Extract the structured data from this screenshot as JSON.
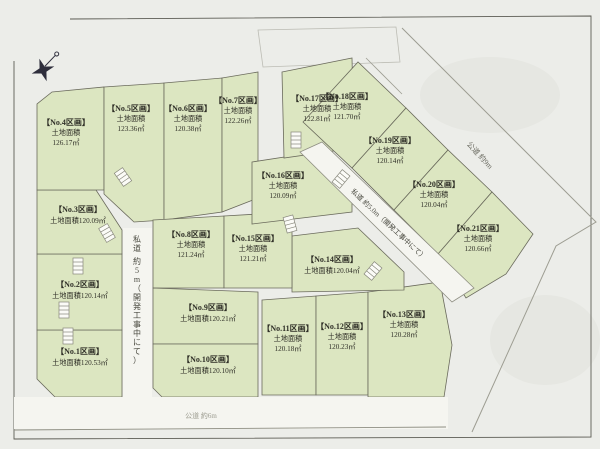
{
  "map": {
    "type": "land-subdivision-plot-map",
    "colors": {
      "paper": "#ecede9",
      "blob": "#e6e7e2",
      "road": "#f5f5f0",
      "plot_fill": "#dce6c1",
      "plot_stroke": "#6a6a5c",
      "label_ink": "#2f2f27"
    },
    "area_label": "土地面積",
    "plots": [
      {
        "no": "No.1",
        "label": "【No.1区画】",
        "area_label": "土地面積",
        "area": "120.53㎡",
        "lines": 2,
        "cx": 80,
        "cy": 358,
        "polygon": "37,330 122,330 122,397 55,397 37,379"
      },
      {
        "no": "No.2",
        "label": "【No.2区画】",
        "area_label": "土地面積",
        "area": "120.14㎡",
        "lines": 2,
        "cx": 80,
        "cy": 291,
        "polygon": "37,254 122,254 122,330 37,330"
      },
      {
        "no": "No.3",
        "label": "【No.3区画】",
        "area_label": "土地面積",
        "area": "120.09㎡",
        "lines": 2,
        "cx": 78,
        "cy": 216,
        "polygon": "37,190 96,190 122,230 122,254 37,254"
      },
      {
        "no": "No.4",
        "label": "【No.4区画】",
        "area_label": "土地面積",
        "area": "126.17㎡",
        "lines": 3,
        "cx": 66,
        "cy": 134,
        "polygon": "52,92 104,87 104,190 37,190 37,104"
      },
      {
        "no": "No.5",
        "label": "【No.5区画】",
        "area_label": "土地面積",
        "area": "123.36㎡",
        "lines": 3,
        "cx": 131,
        "cy": 120,
        "polygon": "104,87 164,83 164,220 134,222 104,194"
      },
      {
        "no": "No.6",
        "label": "【No.6区画】",
        "area_label": "土地面積",
        "area": "120.38㎡",
        "lines": 3,
        "cx": 188,
        "cy": 120,
        "polygon": "164,83 222,78 222,212 164,220"
      },
      {
        "no": "No.7",
        "label": "【No.7区画】",
        "area_label": "土地面積",
        "area": "122.26㎡",
        "lines": 3,
        "cx": 238,
        "cy": 112,
        "polygon": "222,78 258,72 258,198 222,212"
      },
      {
        "no": "No.8",
        "label": "【No.8区画】",
        "area_label": "土地面積",
        "area": "121.24㎡",
        "lines": 3,
        "cx": 191,
        "cy": 246,
        "polygon": "153,220 224,216 224,288 153,288"
      },
      {
        "no": "No.9",
        "label": "【No.9区画】",
        "area_label": "土地面積",
        "area": "120.21㎡",
        "lines": 2,
        "cx": 208,
        "cy": 314,
        "polygon": "153,288 258,292 258,344 153,344"
      },
      {
        "no": "No.10",
        "label": "【No.10区画】",
        "area_label": "土地面積",
        "area": "120.10㎡",
        "lines": 2,
        "cx": 208,
        "cy": 366,
        "polygon": "153,344 258,344 258,397 162,397 153,388"
      },
      {
        "no": "No.11",
        "label": "【No.11区画】",
        "area_label": "土地面積",
        "area": "120.18㎡",
        "lines": 3,
        "cx": 288,
        "cy": 340,
        "polygon": "262,300 316,296 316,395 262,395"
      },
      {
        "no": "No.12",
        "label": "【No.12区画】",
        "area_label": "土地面積",
        "area": "120.23㎡",
        "lines": 3,
        "cx": 342,
        "cy": 338,
        "polygon": "316,296 368,292 368,395 316,395"
      },
      {
        "no": "No.13",
        "label": "【No.13区画】",
        "area_label": "土地面積",
        "area": "120.28㎡",
        "lines": 3,
        "cx": 404,
        "cy": 326,
        "polygon": "368,292 440,282 452,345 444,397 368,397"
      },
      {
        "no": "No.14",
        "label": "【No.14区画】",
        "area_label": "土地面積",
        "area": "120.04㎡",
        "lines": 2,
        "cx": 332,
        "cy": 266,
        "polygon": "292,236 358,228 404,272 404,290 292,292"
      },
      {
        "no": "No.15",
        "label": "【No.15区画】",
        "area_label": "土地面積",
        "area": "121.21㎡",
        "lines": 3,
        "cx": 253,
        "cy": 250,
        "polygon": "224,216 292,212 292,288 224,288"
      },
      {
        "no": "No.16",
        "label": "【No.16区画】",
        "area_label": "土地面積",
        "area": "120.09㎡",
        "lines": 3,
        "cx": 283,
        "cy": 187,
        "polygon": "252,162 330,150 352,174 352,212 252,224"
      },
      {
        "no": "No.17",
        "label": "【No.17区画】",
        "area_label": "土地面積",
        "area": "122.81㎡",
        "lines": 3,
        "cx": 317,
        "cy": 110,
        "polygon": "282,72 352,58 354,148 284,158"
      },
      {
        "no": "No.18",
        "label": "【No.18区画】",
        "area_label": "土地面積",
        "area": "121.70㎡",
        "lines": 3,
        "cx": 347,
        "cy": 108,
        "polygon": "303,122 358,62 406,108 352,168"
      },
      {
        "no": "No.19",
        "label": "【No.19区画】",
        "area_label": "土地面積",
        "area": "120.14㎡",
        "lines": 3,
        "cx": 390,
        "cy": 152,
        "polygon": "352,168 406,108 448,150 394,210"
      },
      {
        "no": "No.20",
        "label": "【No.20区画】",
        "area_label": "土地面積",
        "area": "120.04㎡",
        "lines": 3,
        "cx": 434,
        "cy": 196,
        "polygon": "394,210 448,150 492,192 438,254"
      },
      {
        "no": "No.21",
        "label": "【No.21区画】",
        "area_label": "土地面積",
        "area": "120.66㎡",
        "lines": 3,
        "cx": 478,
        "cy": 240,
        "polygon": "438,254 492,192 533,234 506,274 466,298"
      }
    ],
    "road_labels": [
      {
        "id": "private-road-vertical",
        "text": "私道 約5m（開発工事中にて）",
        "vertical": true,
        "x": 137,
        "y": 242,
        "rotate": 0,
        "size": 8,
        "color": "#4a4a40"
      },
      {
        "id": "private-road-diagonal",
        "text": "私道 約5.0m（開発工事中にて）",
        "vertical": false,
        "x": 387,
        "y": 226,
        "rotate": 43,
        "size": 7,
        "color": "#4a4a40"
      },
      {
        "id": "public-road-north",
        "text": "公道 約9m",
        "vertical": false,
        "x": 478,
        "y": 157,
        "rotate": 47,
        "size": 7.5,
        "color": "#6a6a60"
      },
      {
        "id": "public-road-south",
        "text": "公道 約6m",
        "vertical": false,
        "x": 201,
        "y": 418,
        "rotate": 0,
        "size": 7,
        "color": "#9a9a8e"
      }
    ],
    "stairs": [
      [
        107,
        233,
        -30
      ],
      [
        78,
        266,
        0
      ],
      [
        64,
        310,
        0
      ],
      [
        68,
        336,
        0
      ],
      [
        123,
        177,
        -35
      ],
      [
        296,
        140,
        0
      ],
      [
        290,
        224,
        -15
      ],
      [
        341,
        179,
        40
      ],
      [
        373,
        271,
        40
      ]
    ],
    "compass": {
      "color": "#2e2e3c"
    }
  }
}
